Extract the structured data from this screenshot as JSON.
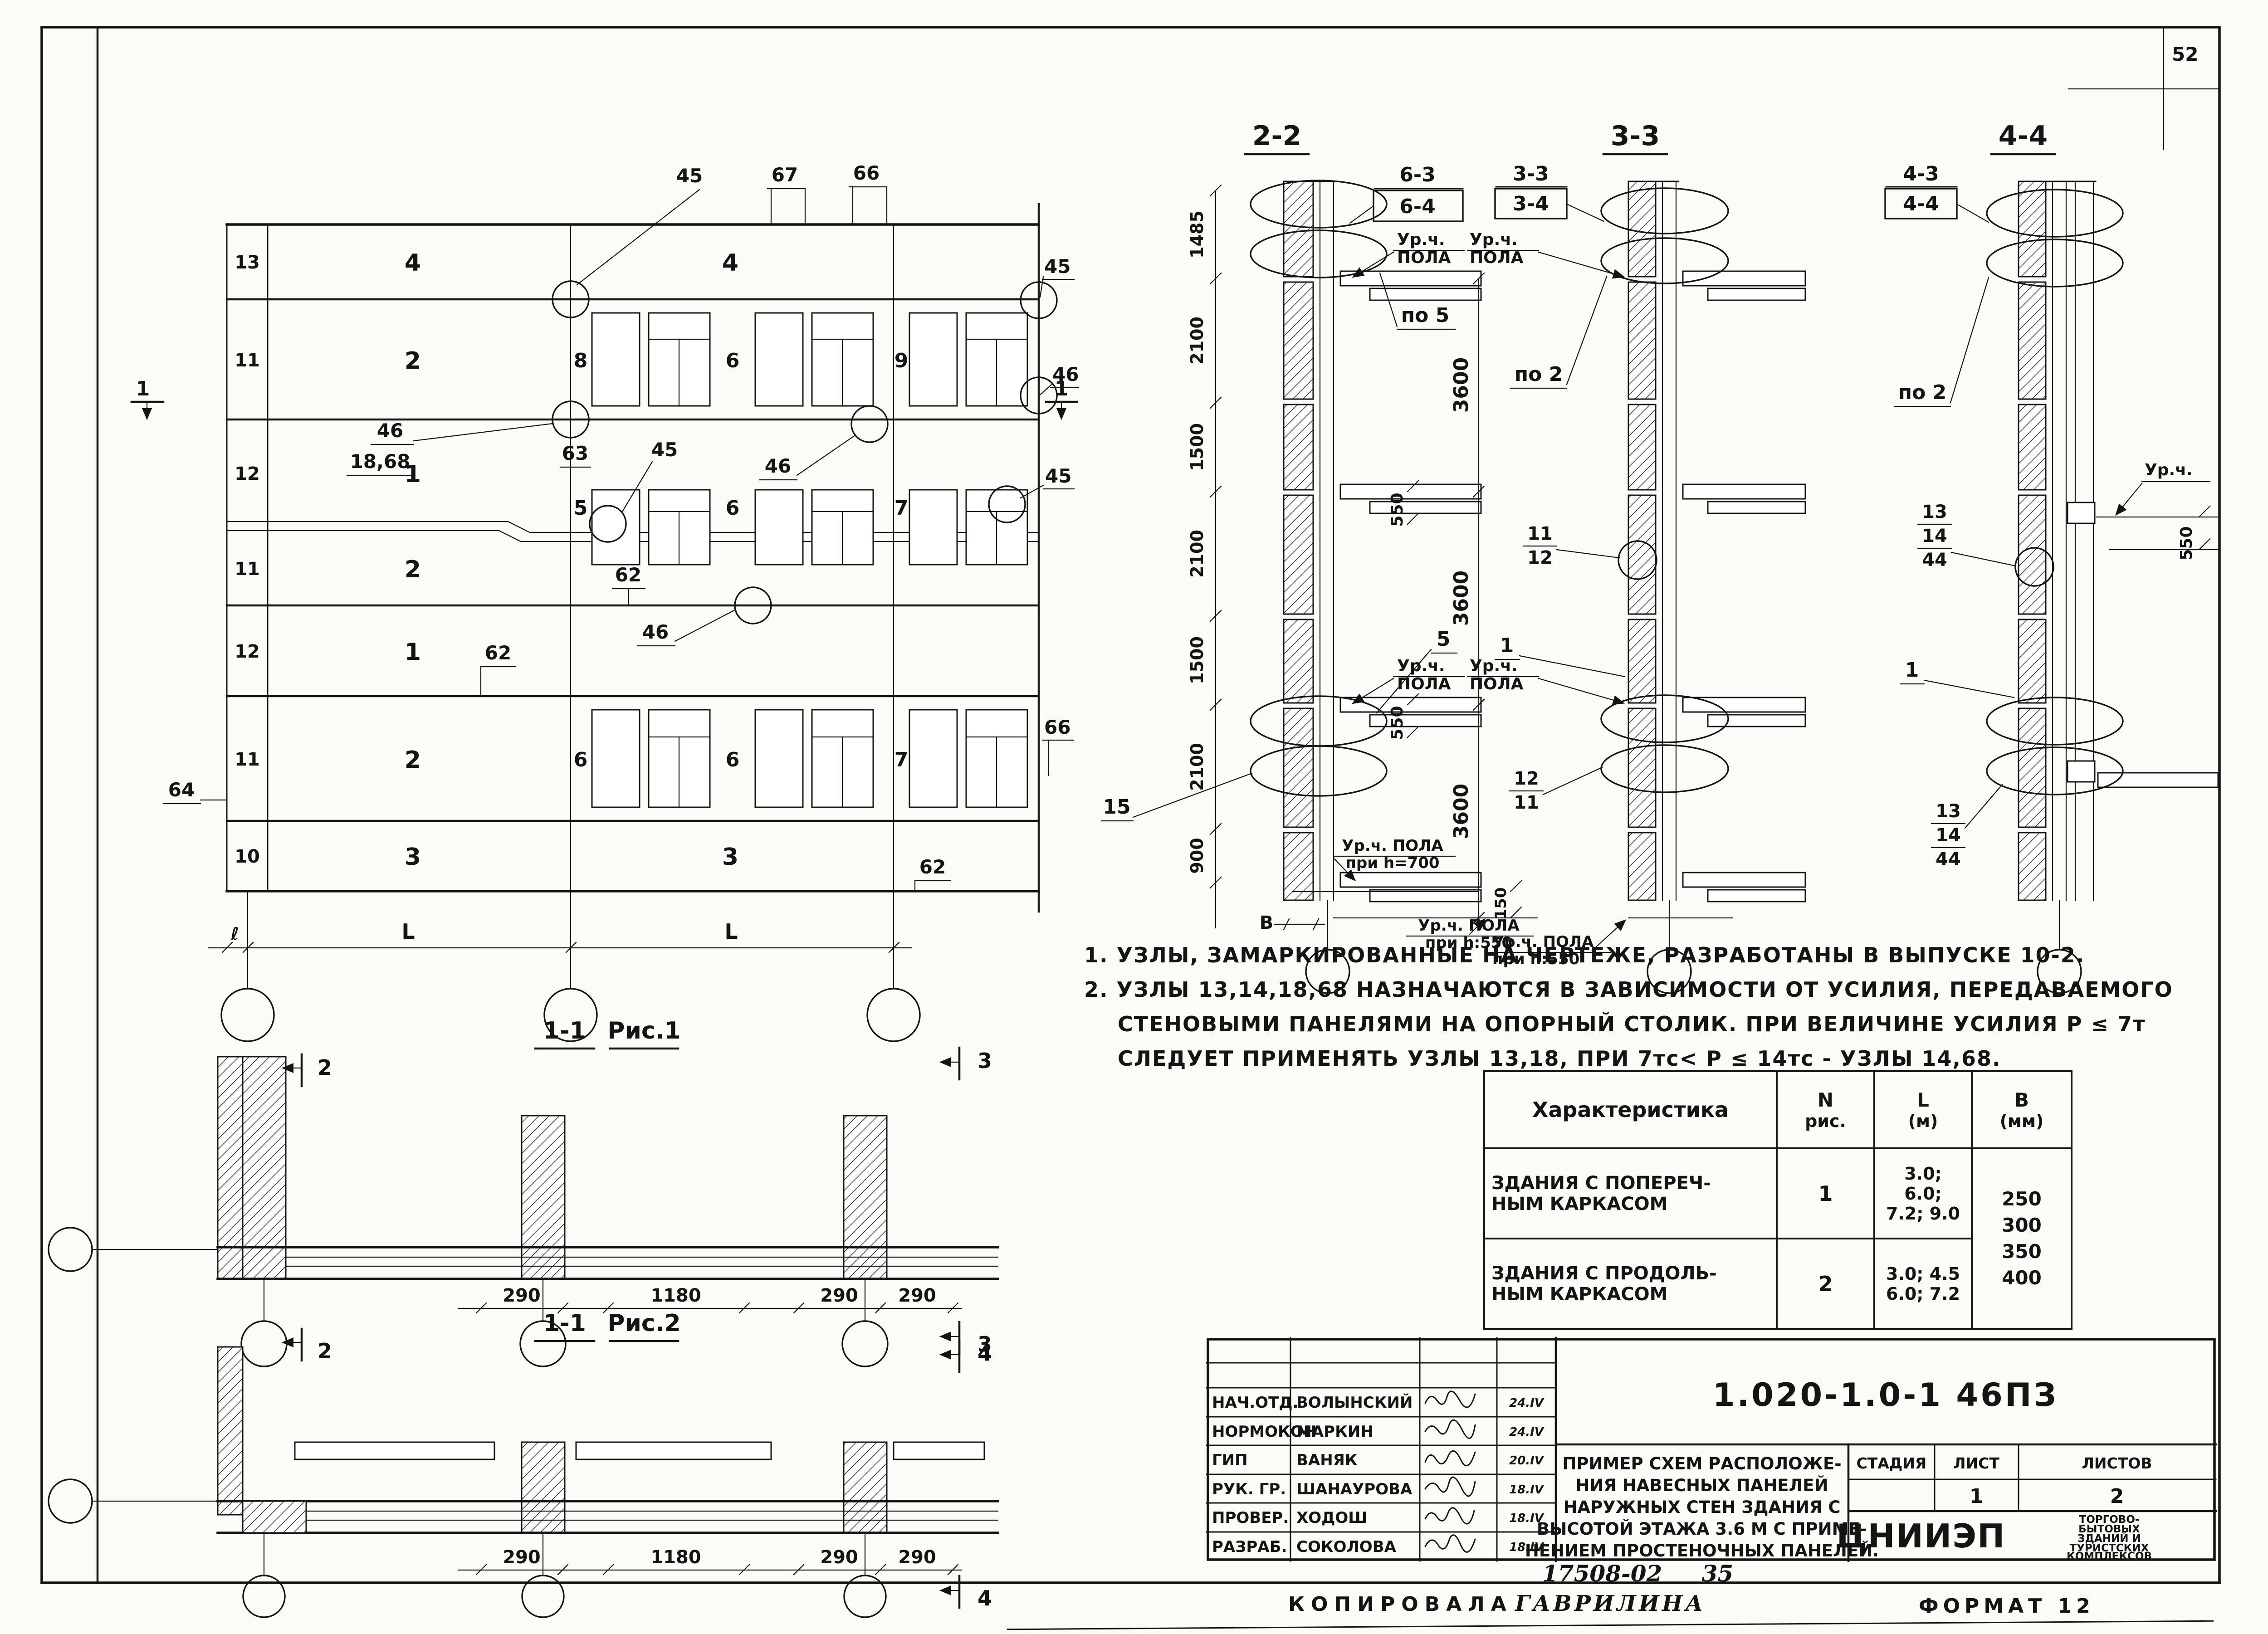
{
  "page": {
    "number": "52",
    "stamp": "17508-02",
    "stamp2": "35",
    "copied_label": "КОПИРОВАЛА",
    "copied_name": "ГАВРИЛИНА",
    "format": "ФОРМАТ 12",
    "ink_color": "#141414",
    "paper_color": "#fbfbf8"
  },
  "facade": {
    "top_callouts": [
      "45",
      "67",
      "66"
    ],
    "right_callouts": [
      "45",
      "46",
      "45",
      "66"
    ],
    "rows": [
      {
        "id": "13",
        "panel": "4"
      },
      {
        "id": "11",
        "panel": "2"
      },
      {
        "id": "12",
        "panel": "1"
      },
      {
        "id": "11",
        "panel": "2"
      },
      {
        "id": "12",
        "panel": "1"
      },
      {
        "id": "11",
        "panel": "2"
      },
      {
        "id": "10",
        "panel": "3"
      }
    ],
    "bay2_top": "4",
    "bay2_bottom": "3",
    "win_rows": [
      [
        "8",
        "6",
        "9"
      ],
      [
        "5",
        "6",
        "7"
      ],
      [
        "6",
        "6",
        "7"
      ]
    ],
    "labels": {
      "l46a": "46",
      "l1868": "18,68",
      "l63": "63",
      "l45": "45",
      "l46b": "46",
      "l46c": "46",
      "l62a": "62",
      "l62b": "62",
      "l62c": "62",
      "l64": "64",
      "sec": "1"
    },
    "spans": [
      "ℓ",
      "L",
      "L"
    ]
  },
  "s22": {
    "title": "2-2",
    "ref_top": "6-3",
    "ref_bot": "6-4",
    "note": "по 5",
    "callout5": "5",
    "callout15": "15",
    "dims_left": [
      "1485",
      "2100",
      "1500",
      "2100",
      "1500",
      "2100",
      "900"
    ],
    "dims_right": [
      "3600",
      "3600",
      "3600"
    ],
    "d550": "550",
    "d150": "150",
    "b": "В",
    "ur": "Ур.ч.",
    "pola": "ПОЛА",
    "floor700a": "Ур.ч. ПОЛА",
    "floor700b": "при h=700",
    "floor550a": "Ур.ч. ПОЛА",
    "floor550b": "при h:550"
  },
  "s33": {
    "title": "3-3",
    "ref_top": "3-3",
    "ref_bot": "3-4",
    "note": "по 2",
    "ur": "Ур.ч.",
    "pola": "ПОЛА",
    "f1a": "11",
    "f1b": "12",
    "mid": "1",
    "f2a": "12",
    "f2b": "11",
    "floor550a": "Ур.ч. ПОЛА",
    "floor550b": "при h:550"
  },
  "s44": {
    "title": "4-4",
    "ref_top": "4-3",
    "ref_bot": "4-4",
    "note": "по 2",
    "ur": "Ур.ч.",
    "d550": "550",
    "f1a": "13",
    "f1b": "14",
    "f1c": "44",
    "mid": "1",
    "f2a": "13",
    "f2b": "14",
    "f2c": "44"
  },
  "notes": {
    "n1": "1. УЗЛЫ, ЗАМАРКИРОВАННЫЕ НА ЧЕРТЕЖЕ, РАЗРАБОТАНЫ В ВЫПУСКЕ 10-2.",
    "n2": "2. УЗЛЫ 13,14,18,68 НАЗНАЧАЮТСЯ В ЗАВИСИМОСТИ ОТ УСИЛИЯ, ПЕРЕДАВАЕМОГО",
    "n3": "СТЕНОВЫМИ ПАНЕЛЯМИ НА ОПОРНЫЙ СТОЛИК. ПРИ ВЕЛИЧИНЕ УСИЛИЯ Р ≤ 7т",
    "n4": "СЛЕДУЕТ ПРИМЕНЯТЬ УЗЛЫ 13,18, ПРИ 7тс< Р ≤ 14тс - УЗЛЫ 14,68."
  },
  "table": {
    "h_char": "Характеристика",
    "h_n1": "N",
    "h_n2": "рис.",
    "h_l1": "L",
    "h_l2": "(м)",
    "h_b1": "В",
    "h_b2": "(мм)",
    "r1a": "ЗДАНИЯ С ПОПЕРЕЧ-",
    "r1b": "НЫМ КАРКАСОМ",
    "r1n": "1",
    "r1l1": "3.0;",
    "r1l2": "6.0;",
    "r1l3": "7.2; 9.0",
    "r2a": "ЗДАНИЯ С ПРОДОЛЬ-",
    "r2b": "НЫМ КАРКАСОМ",
    "r2n": "2",
    "r2l1": "3.0; 4.5",
    "r2l2": "6.0; 7.2",
    "b1": "250",
    "b2": "300",
    "b3": "350",
    "b4": "400"
  },
  "tb": {
    "doc": "1.020-1.0-1 46ПЗ",
    "roles": [
      {
        "r": "НАЧ.ОТД.",
        "n": "ВОЛЫНСКИЙ",
        "d": "24.IV"
      },
      {
        "r": "НОРМОКОН",
        "n": "МАРКИН",
        "d": "24.IV"
      },
      {
        "r": "ГИП",
        "n": "ВАНЯК",
        "d": "20.IV"
      },
      {
        "r": "РУК. ГР.",
        "n": "ШАНАУРОВА",
        "d": "18.IV"
      },
      {
        "r": "ПРОВЕР.",
        "n": "ХОДОШ",
        "d": "18.IV"
      },
      {
        "r": "РАЗРАБ.",
        "n": "СОКОЛОВА",
        "d": "18.IV"
      }
    ],
    "t1": "ПРИМЕР СХЕМ РАСПОЛОЖЕ-",
    "t2": "НИЯ НАВЕСНЫХ ПАНЕЛЕЙ",
    "t3": "НАРУЖНЫХ СТЕН ЗДАНИЯ С",
    "t4": "ВЫСОТОЙ ЭТАЖА 3.6 М С ПРИМЕ-",
    "t5": "НЕНИЕМ ПРОСТЕНОЧНЫХ ПАНЕЛЕЙ.",
    "stage": "СТАДИЯ",
    "sheet": "ЛИСТ",
    "sheets": "ЛИСТОВ",
    "stage_v": "",
    "sheet_v": "1",
    "sheets_v": "2",
    "org": "ЦНИИЭП",
    "o1": "ТОРГОВО-",
    "o2": "БЫТОВЫХ",
    "o3": "ЗДАНИЙ И",
    "o4": "ТУРИСТСКИХ",
    "o5": "КОМПЛЕКСОВ"
  },
  "fig1": {
    "ta": "1-1",
    "tb": "Рис.1",
    "d1": "290",
    "d2": "1180",
    "d3": "290",
    "d4": "290",
    "fl": "2",
    "fr": "3"
  },
  "fig2": {
    "ta": "1-1",
    "tb": "Рис.2",
    "d1": "290",
    "d2": "1180",
    "d3": "290",
    "d4": "290",
    "fr": "4"
  }
}
